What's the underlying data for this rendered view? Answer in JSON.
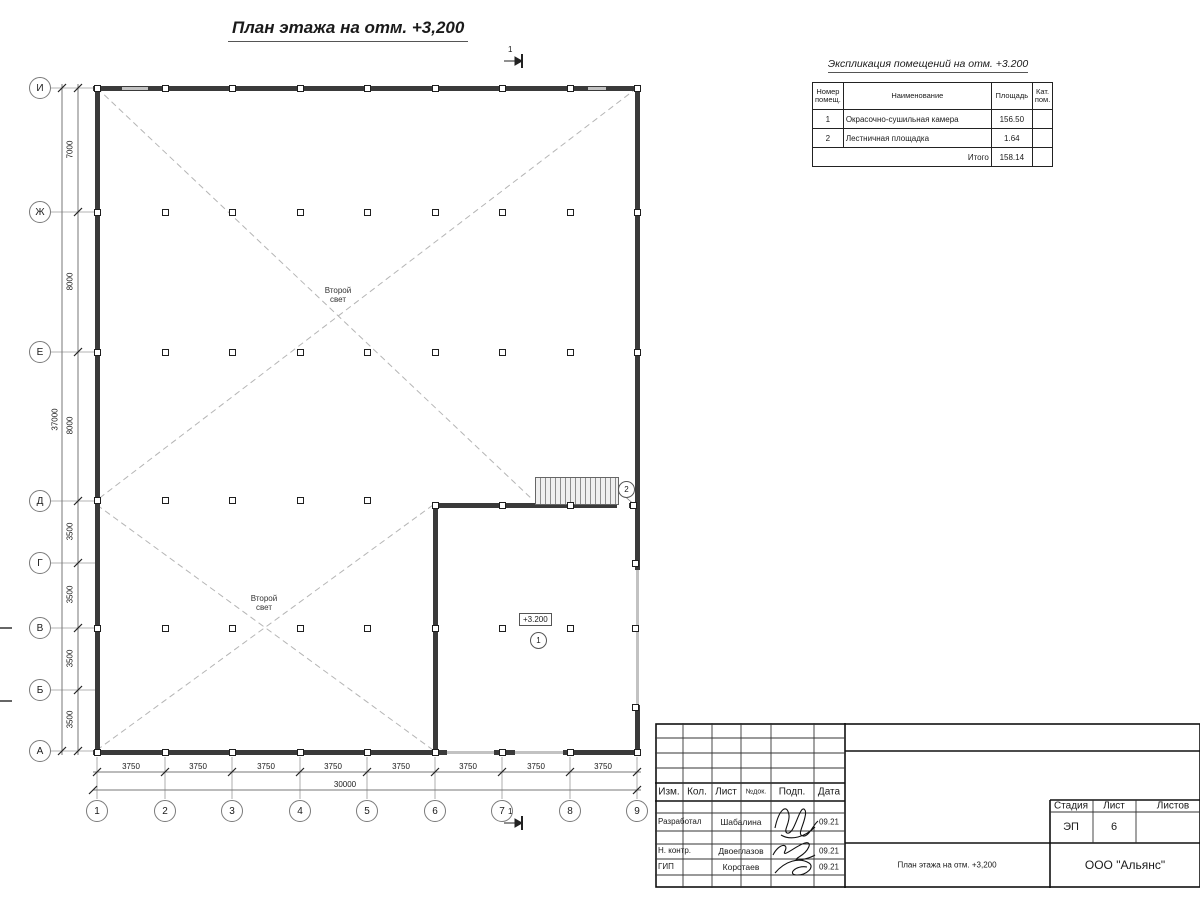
{
  "plan": {
    "title": "План этажа на отм. +3,200",
    "section_mark": "1",
    "void_line1": "Второй",
    "void_line2": "свет",
    "elevation_mark": "+3.200",
    "room_marks": {
      "paint_chamber": "1",
      "stair_landing": "2"
    }
  },
  "axes": {
    "left": [
      "И",
      "Ж",
      "Е",
      "Д",
      "Г",
      "В",
      "Б",
      "А"
    ],
    "bottom": [
      "1",
      "2",
      "3",
      "4",
      "5",
      "6",
      "7",
      "8",
      "9"
    ]
  },
  "dims": {
    "left": [
      "7000",
      "8000",
      "8000",
      "3500",
      "3500",
      "3500",
      "3500"
    ],
    "left_total": "37000",
    "bottom": [
      "3750",
      "3750",
      "3750",
      "3750",
      "3750",
      "3750",
      "3750",
      "3750"
    ],
    "bottom_total": "30000"
  },
  "explication": {
    "title": "Экспликация помещений на отм. +3.200",
    "headers": {
      "num": "Номер помещ.",
      "name": "Наименование",
      "area": "Площадь",
      "cat": "Кат. пом."
    },
    "rows": [
      {
        "num": "1",
        "name": "Окрасочно-сушильная камера",
        "area": "156.50",
        "cat": ""
      },
      {
        "num": "2",
        "name": "Лестничная площадка",
        "area": "1.64",
        "cat": ""
      }
    ],
    "total_label": "Итого",
    "total_area": "158.14"
  },
  "title_block": {
    "headers": {
      "izm": "Изм.",
      "kol": "Кол.",
      "list": "Лист",
      "ndok": "№док.",
      "podp": "Подп.",
      "data": "Дата"
    },
    "rows": [
      {
        "role": "Разработал",
        "name": "Шабалина",
        "date": "09.21"
      },
      {
        "role": "Н. контр.",
        "name": "Двоеглазов",
        "date": "09.21"
      },
      {
        "role": "ГИП",
        "name": "Коротаев",
        "date": "09.21"
      }
    ],
    "stage_label": "Стадия",
    "sheet_label": "Лист",
    "sheets_label": "Листов",
    "stage": "ЭП",
    "sheet": "6",
    "doc_title": "План этажа на отм. +3,200",
    "company": "ООО \"Альянс\""
  },
  "colors": {
    "wall": "#3a3a3a",
    "opening": "#c2c2c2",
    "line": "#777777",
    "dashed": "#b5b5b5"
  }
}
